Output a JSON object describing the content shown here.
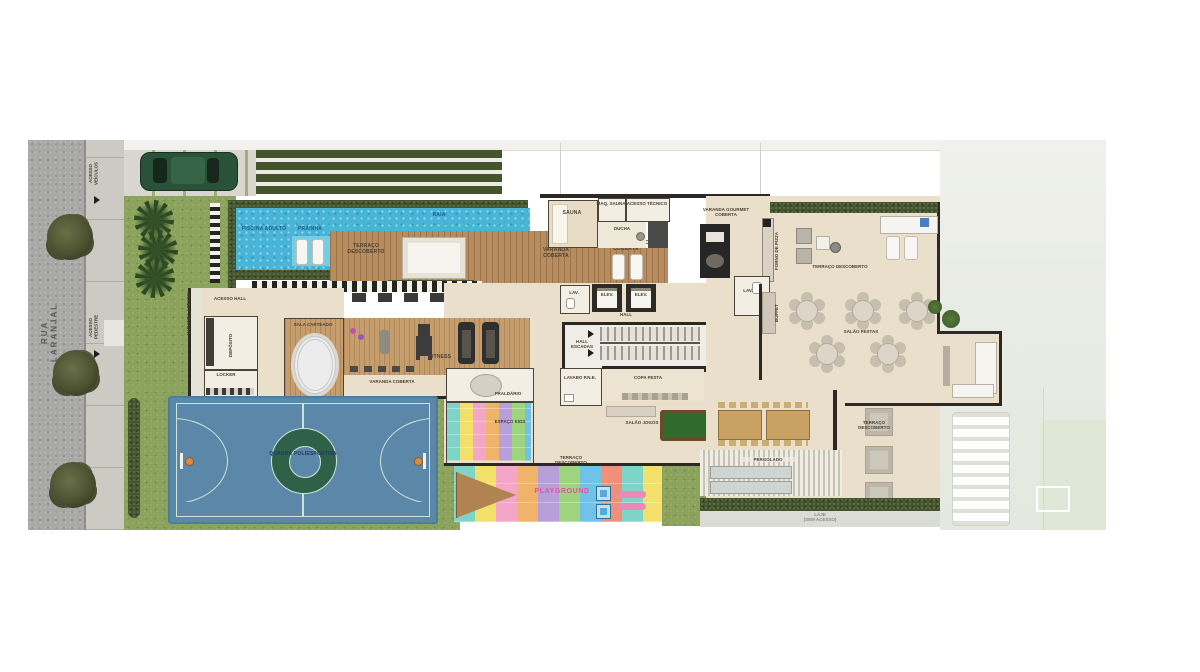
{
  "street": {
    "name": "RUA LARANJAL"
  },
  "access": {
    "vehicles": "ACESSO VEÍCULOS",
    "pedestrians": "ACESSO PEDESTRE"
  },
  "pool": {
    "adult": "PISCINA ADULTO",
    "beach": "PRAINHA",
    "lane": "RAIA"
  },
  "deck": {
    "open": "TERRAÇO DESCOBERTO",
    "covered": "VARANDA COBERTA",
    "rest": "ÁREA DESCANSO COBERTA"
  },
  "sauna": {
    "room": "SAUNA",
    "machine": "MAQ. SAUNA",
    "tech": "ACESSO TÉCNICO",
    "shower": "DUCHA"
  },
  "west": {
    "hall_access": "ACESSO HALL",
    "varanda": "VARANDA ACESSO",
    "storage": "DEPÓSITO",
    "locker": "LOCKER",
    "cards": "SALA CARTEADO"
  },
  "gym": {
    "name": "FITNESS",
    "varanda": "VARANDA COBERTA"
  },
  "kids": {
    "fraldario": "FRALDÁRIO",
    "space": "ESPAÇO KIDS",
    "playground": "PLAYGROUND"
  },
  "core": {
    "lav": "LAV.",
    "elev": "ELEV.",
    "elev2": "ELEV.",
    "hall": "HALL",
    "stairs": "HALL ESCADAS",
    "lavabo": "LAVABO P.N.E.",
    "copa": "COPA FESTA",
    "games": "SALÃO JOGOS",
    "terrace": "TERRAÇO DESCOBERTO"
  },
  "east": {
    "gourmet": "VARANDA GOURMET COBERTA",
    "pizza": "FORNO DE PIZZA",
    "lav": "LAV.",
    "terrace_top": "TERRAÇO DESCOBERTO",
    "party": "SALÃO FESTAS",
    "buffet": "BUFFET",
    "pergola": "PERGOLADO",
    "terrace_side": "TERRAÇO DESCOBERTO",
    "slab": "LAJE",
    "slab_note": "(SEM ACESSO)"
  },
  "court": {
    "name": "QUADRA POLIESPORTIVA"
  },
  "colors": {
    "pool_water": "#47b4d8",
    "court_blue": "#5b87a8",
    "court_circle_green": "#2f6148",
    "grass": "#8ba35c",
    "hedge": "#44552e",
    "deck_wood": "#b78c5e",
    "floor_beige": "#e9dfca",
    "playground_label_pink": "#e0559a",
    "pool_label_blue": "#1c5f8c"
  }
}
